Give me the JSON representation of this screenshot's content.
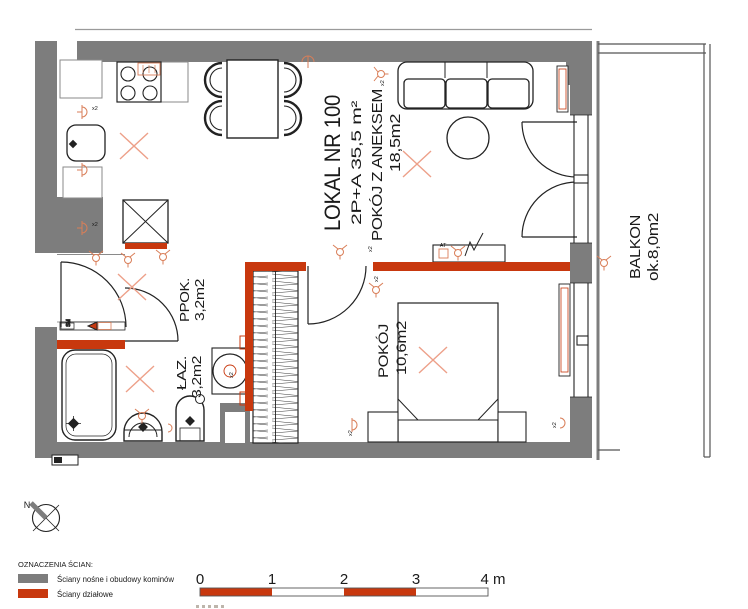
{
  "plan": {
    "title": "LOKAL NR 100",
    "subtitle": "2P+A   35,5 m²",
    "rooms": [
      {
        "name": "POKÓJ Z ANEKSEM",
        "area": "18,5m2"
      },
      {
        "name": "POKÓJ",
        "area": "10,6m2"
      },
      {
        "name": "PPOK.",
        "area": "3,2m2"
      },
      {
        "name": "ŁAZ.",
        "area": "3,2m2"
      },
      {
        "name": "BALKON",
        "area": "ok.8,0m2"
      }
    ]
  },
  "annotations": {
    "socket_multiplier": "x2",
    "antenna_socket": "AT",
    "intercom": "SM"
  },
  "legend": {
    "heading": "OZNACZENIA ŚCIAN:",
    "items": [
      {
        "label": "Ściany nośne i obudowy kominów",
        "color": "#7d7d7d"
      },
      {
        "label": "Ściany działowe",
        "color": "#c8380e"
      }
    ]
  },
  "scale_bar": {
    "ticks": [
      "0",
      "1",
      "2",
      "3",
      "4 m"
    ]
  },
  "compass": {
    "label": "N"
  },
  "colors": {
    "wall": "#7d7d7d",
    "partition": "#c8380e",
    "symbols": "#d97e58",
    "lines": "#222222"
  }
}
